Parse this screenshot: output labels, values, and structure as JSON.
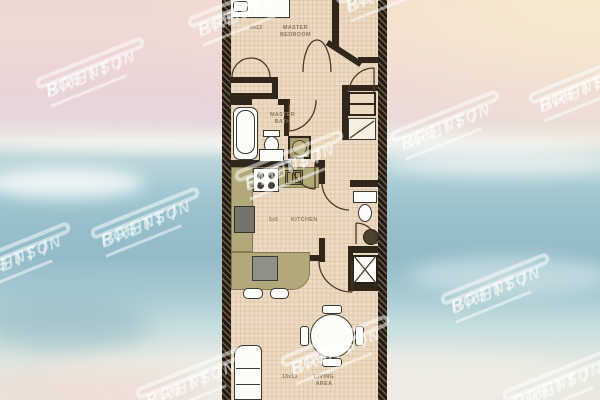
{
  "scene": {
    "description": "One-bedroom condo floor plan over a blurred beach photo",
    "background_colors": {
      "sky_pink": "#e9d4d8",
      "sky_peach": "#f7e9ce",
      "ocean": "#96bfca",
      "foam": "#e0e7e1",
      "sand": "#eae8e0"
    }
  },
  "watermark": {
    "line1": "BRETT /",
    "line2": "ROBINSON",
    "color": "#ffffff"
  },
  "watermarks": [
    {
      "x": 90,
      "y": 87
    },
    {
      "x": 242,
      "y": 26
    },
    {
      "x": 390,
      "y": 2
    },
    {
      "x": 583,
      "y": 102
    },
    {
      "x": 445,
      "y": 140
    },
    {
      "x": 289,
      "y": 180
    },
    {
      "x": 145,
      "y": 237
    },
    {
      "x": 16,
      "y": 272
    },
    {
      "x": 495,
      "y": 303
    },
    {
      "x": 335,
      "y": 365
    },
    {
      "x": 190,
      "y": 397
    },
    {
      "x": 557,
      "y": 399
    }
  ],
  "floorplan": {
    "colors": {
      "floor": "#ecdac3",
      "walls": "#241c12",
      "counters": "#b2a97b",
      "fixtures": "#fdfcf8"
    },
    "rooms": [
      {
        "name": "MASTER BEDROOM",
        "dims": "9x12"
      },
      {
        "name": "MASTER BATH",
        "dims": ""
      },
      {
        "name": "KITCHEN",
        "dims": "5x5"
      },
      {
        "name": "LIVING AREA",
        "dims": "13x13"
      }
    ],
    "fixture_icons": [
      "bed",
      "closet-double-doors",
      "bathtub",
      "toilet",
      "vanity-sink",
      "shower",
      "stove",
      "kitchen-sink",
      "refrigerator",
      "breakfast-bar",
      "bar-stools",
      "dining-table",
      "dining-chairs",
      "sofa",
      "elevator-shaft",
      "guest-toilet",
      "guest-sink",
      "corner-shower",
      "entry-closet",
      "vanity-mirror",
      "balcony-door"
    ]
  }
}
